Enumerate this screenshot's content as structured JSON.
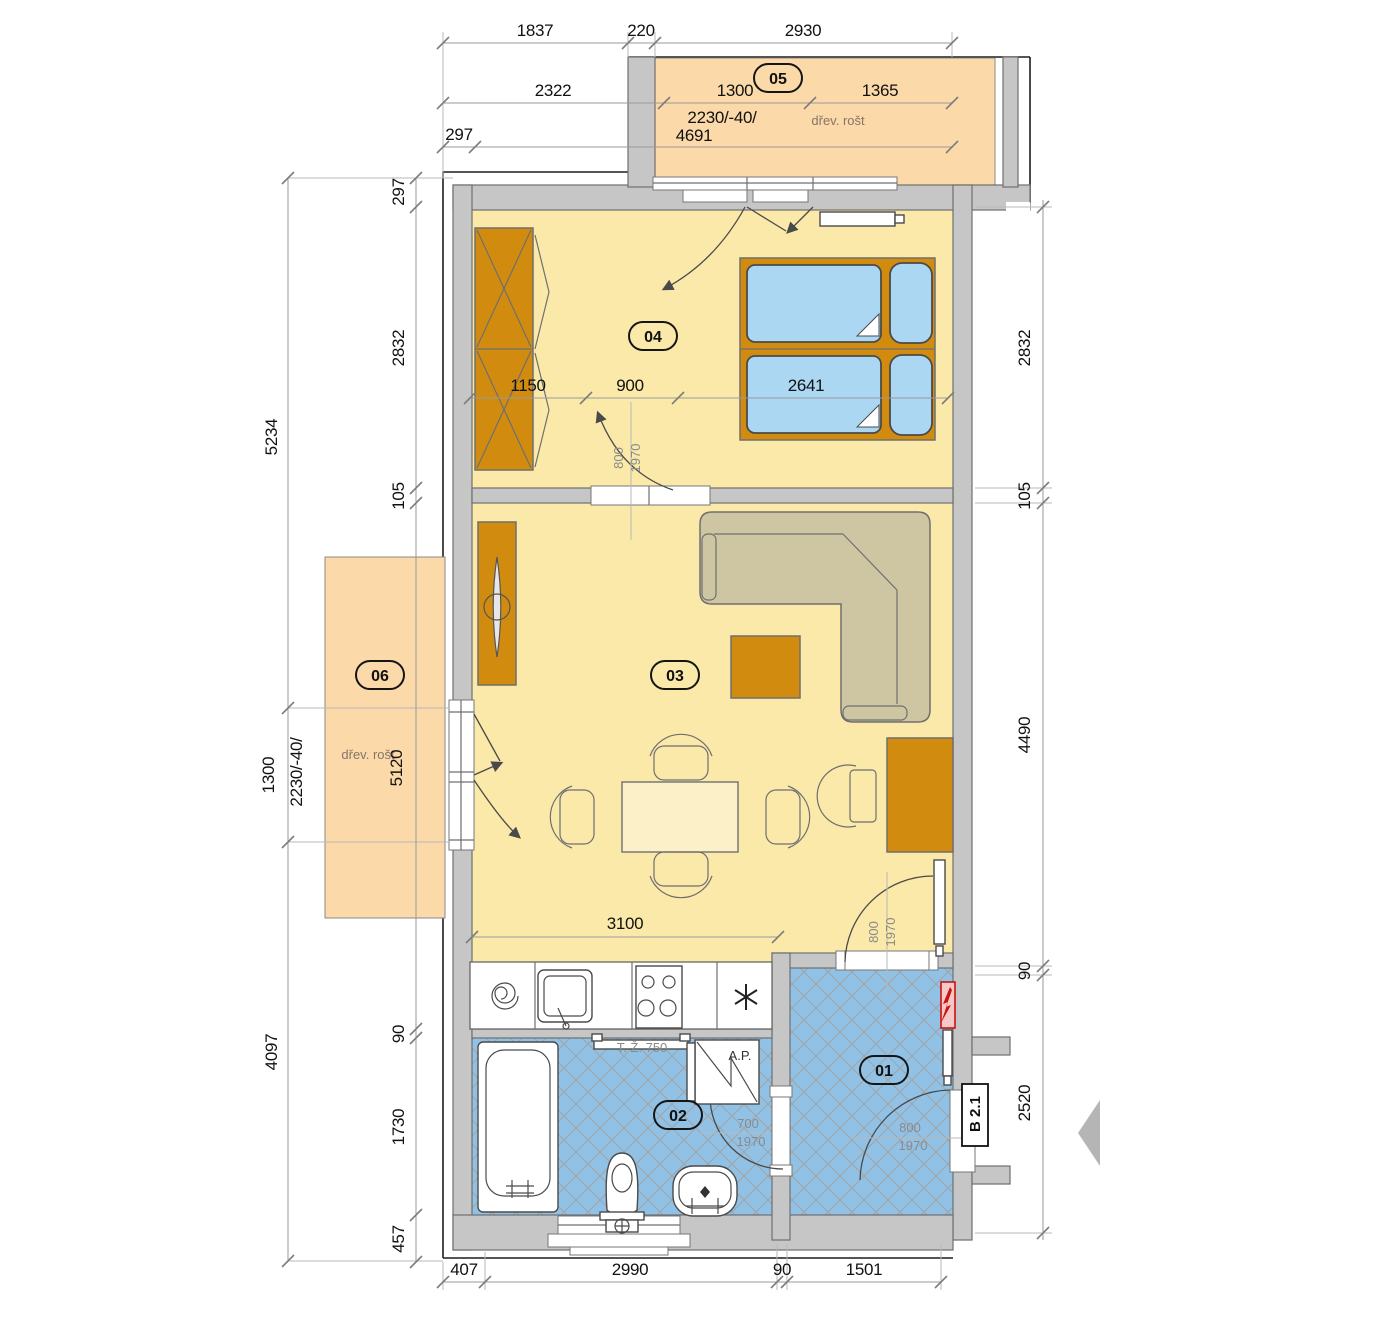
{
  "title": "Apartment floor plan",
  "colors": {
    "floor-yellow": "#fbe9a9",
    "floor-blue": "#92c1e6",
    "balcony-orange": "#fcd9a8",
    "furniture-orange": "#d18c10",
    "mattress-blue": "#abd7f3",
    "sofa-beige": "#cec6a3",
    "wall-gray": "#c6c6c6",
    "wall-stroke": "#6f6f6f",
    "dim-gray": "#9a9a9a",
    "hatch-tan": "#a5937f",
    "accent-red": "#cc1111",
    "label-gray": "#8a8a8a",
    "note-brown": "#85756a"
  },
  "rooms": {
    "r01": "01",
    "r02": "02",
    "r03": "03",
    "r04": "04",
    "r05": "05",
    "r06": "06"
  },
  "notes": {
    "grate5": "dřev. rošt",
    "grate6": "dřev. rošt",
    "towel_rail": "T. Ž. 750",
    "washer": "A.P.",
    "entry_tag": "B 2.1"
  },
  "dims": {
    "t1a": "1837",
    "t1b": "220",
    "t1c": "2930",
    "t2a": "2322",
    "t2b": "1300",
    "t2c": "1365",
    "t3a": "297",
    "t3spec": "2230/-40/",
    "t3b": "4691",
    "lo1": "5234",
    "lo2": "1300",
    "lospec": "2230/-40/",
    "lo3": "4097",
    "li1": "297",
    "li2": "2832",
    "li3": "105",
    "li4": "90",
    "li5": "1730",
    "li6": "457",
    "r1": "2832",
    "r2": "105",
    "r3": "4490",
    "r4": "90",
    "r5": "2520",
    "b1": "407",
    "b2": "2990",
    "b3": "90",
    "b4": "1501",
    "bed1": "1150",
    "bed2": "900",
    "bed3": "2641",
    "liv1": "3100",
    "bal6len": "5120"
  },
  "doors": {
    "bedroom_w": "800",
    "bedroom_h": "1970",
    "living_hall_w": "800",
    "living_hall_h": "1970",
    "bath_w": "700",
    "bath_h": "1970",
    "entry_w": "800",
    "entry_h": "1970"
  }
}
